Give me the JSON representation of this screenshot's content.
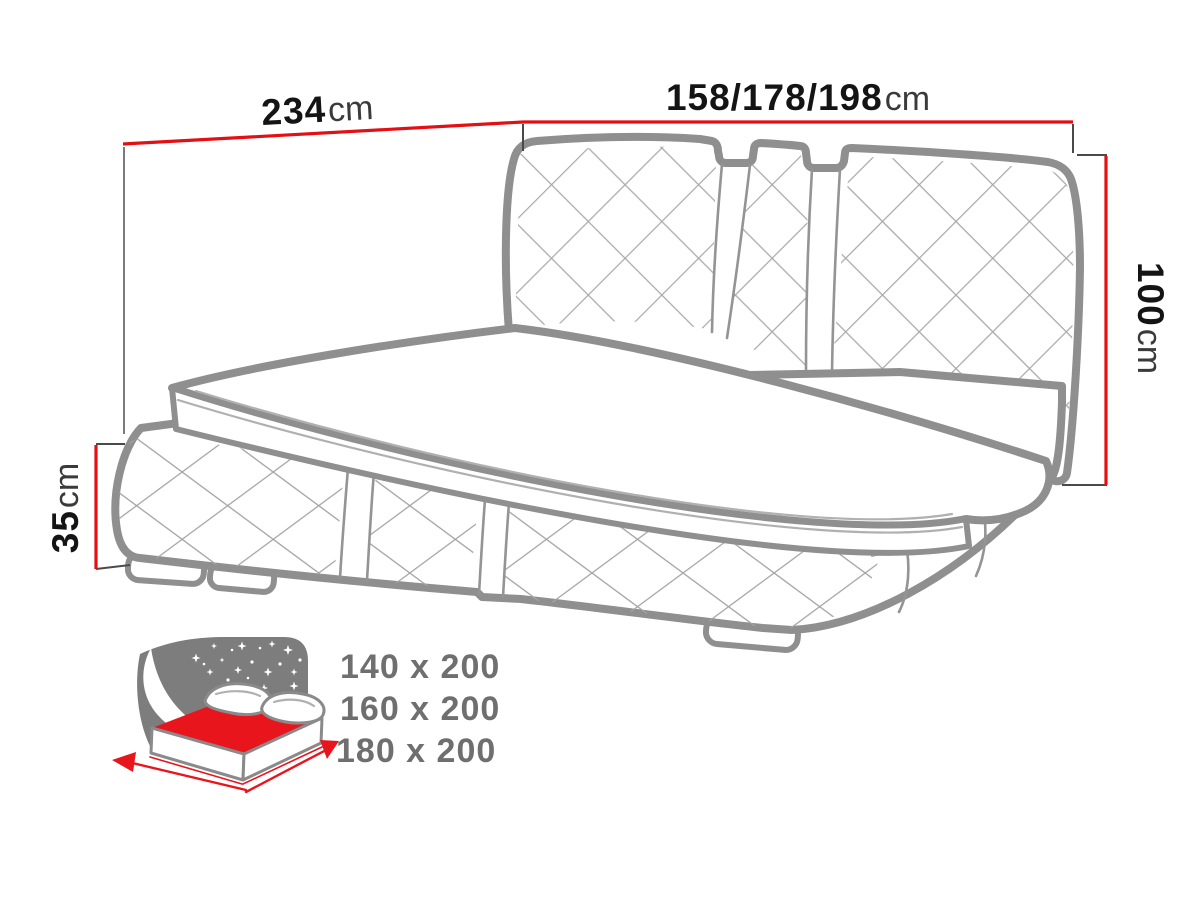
{
  "diagram": {
    "type": "bed-technical-drawing",
    "dimension_labels": {
      "depth": {
        "value": "234",
        "unit": "cm"
      },
      "width": {
        "value": "158/178/198",
        "unit": "cm"
      },
      "headboard_height": {
        "value": "100",
        "unit": "cm"
      },
      "base_height": {
        "value": "35",
        "unit": "cm"
      }
    },
    "mattress_sizes": [
      "140 x 200",
      "160 x 200",
      "180 x 200"
    ],
    "icon": {
      "name": "mattress-size-icon",
      "elements": [
        "starry-headboard",
        "red-mattress",
        "pillows",
        "width-arrow",
        "length-arrow"
      ]
    },
    "colors": {
      "background": "#ffffff",
      "dimension_red": "#e30f13",
      "outline_gray": "#8f8f8f",
      "quilt_gray": "#a8a8a8",
      "value_black": "#141414",
      "unit_gray": "#3a3a3a",
      "sizes_gray": "#6f6f6f",
      "icon_dark_gray": "#7d7d7d",
      "icon_red": "#e8151c"
    }
  }
}
